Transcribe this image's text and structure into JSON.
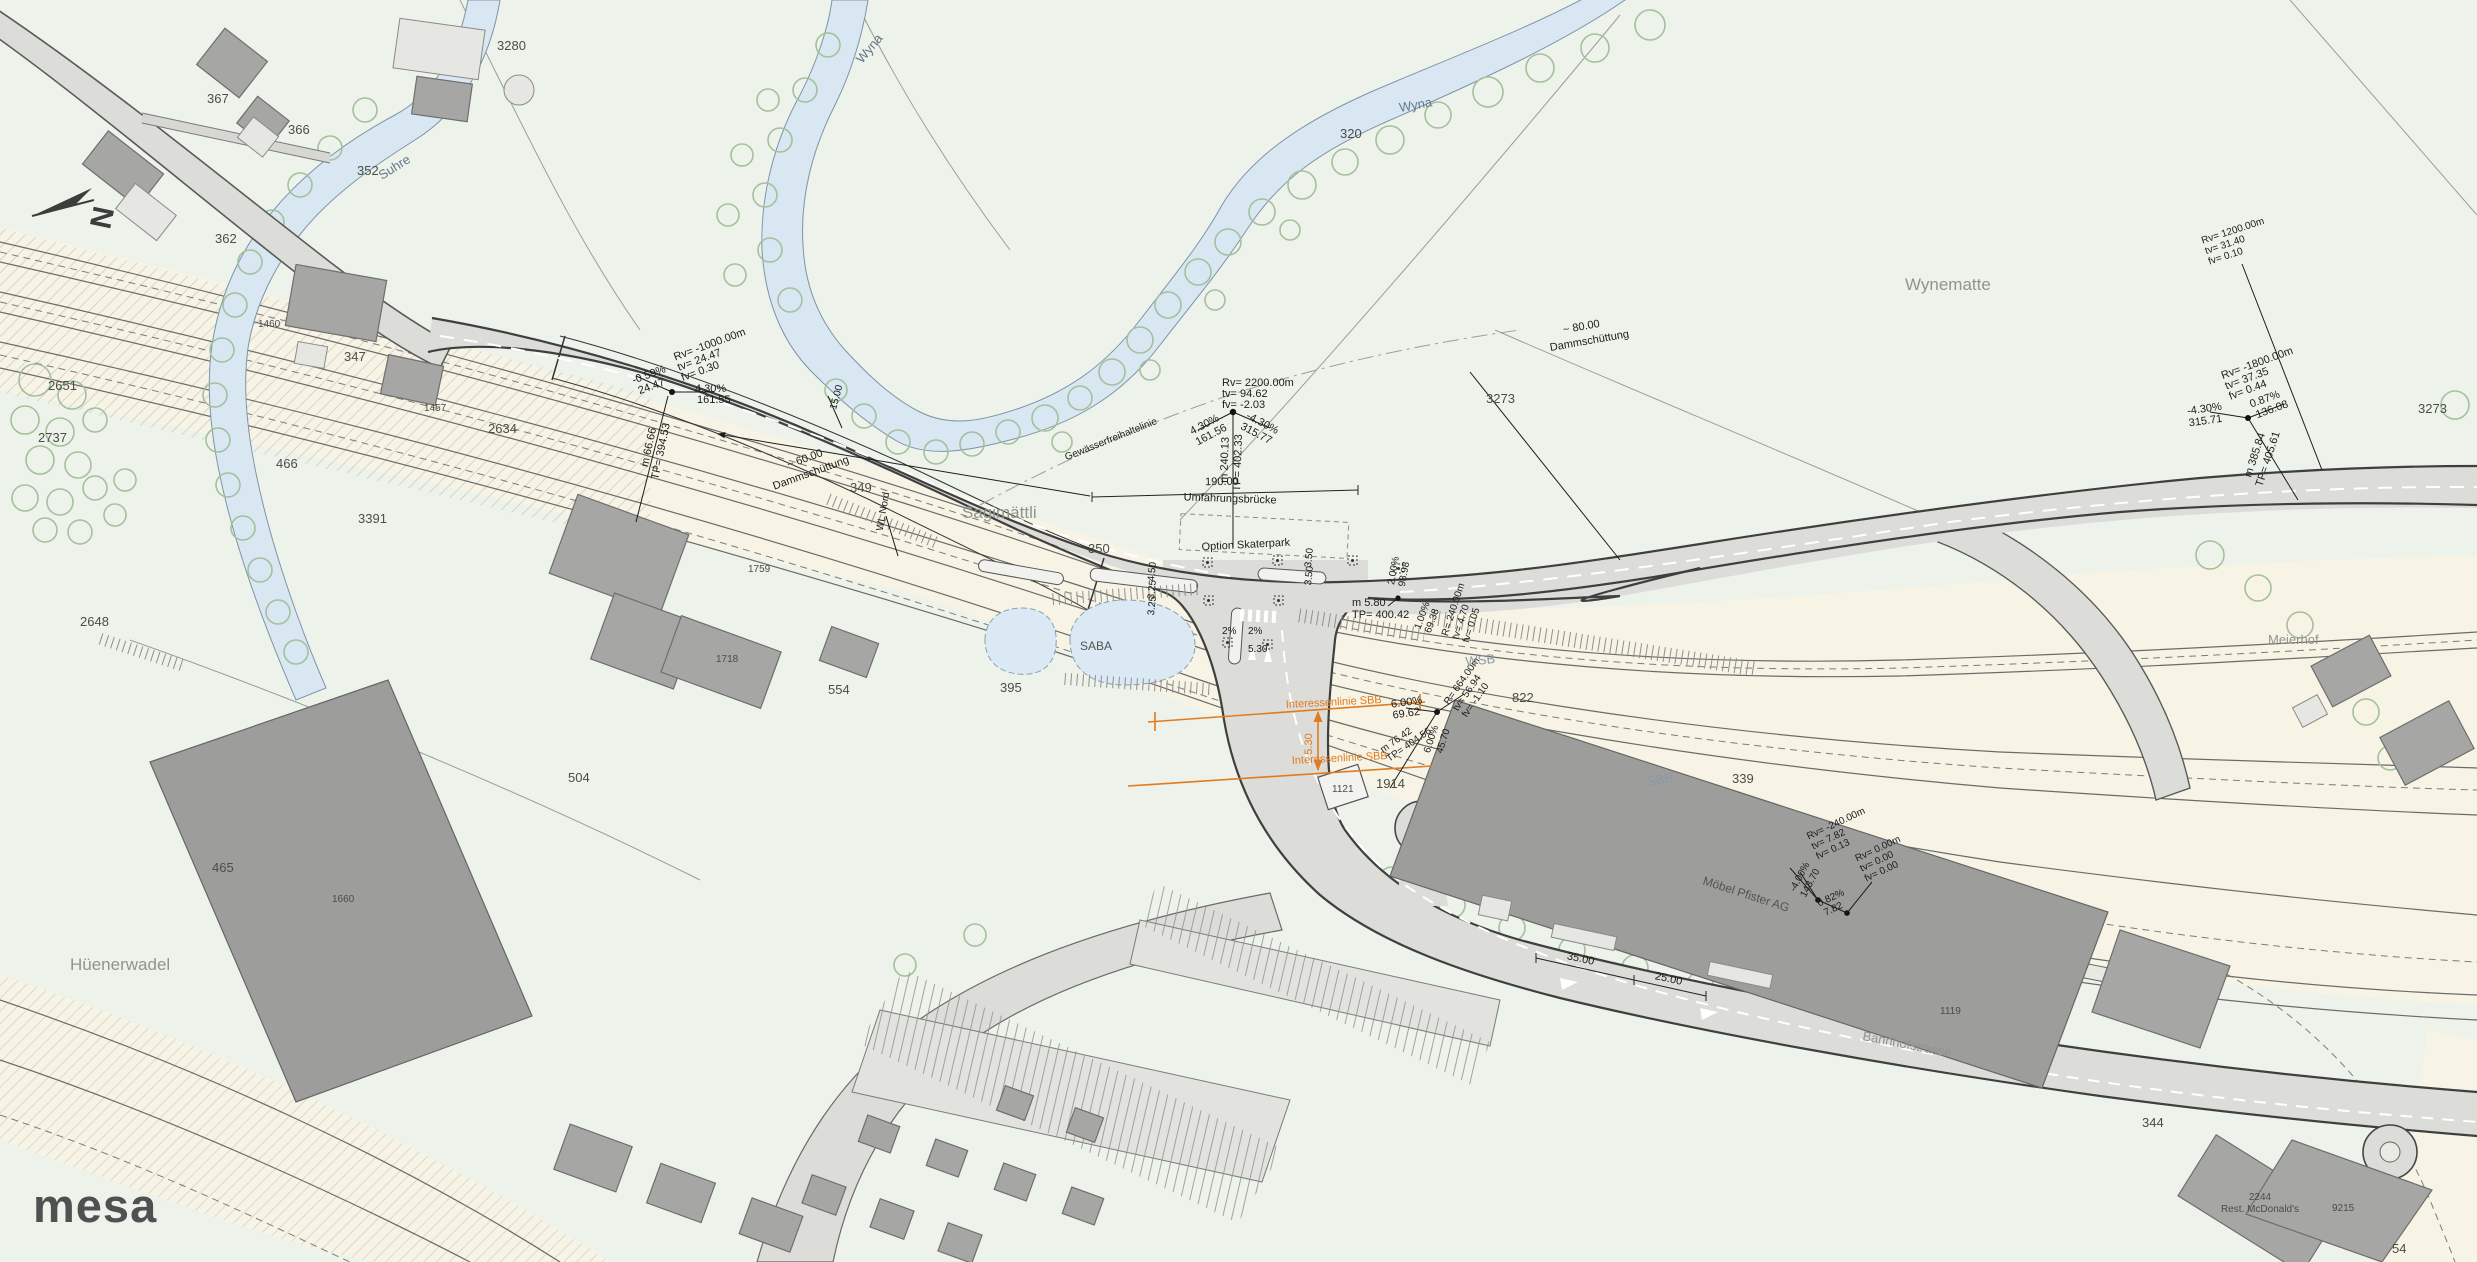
{
  "logo": {
    "text": "mesa"
  },
  "compass": {
    "letter": "N"
  },
  "labels": {
    "wyna1": "Wyna",
    "wyna2": "Wyna",
    "suhre": "Suhre",
    "wynematte": "Wynematte",
    "sagimaettli": "Sagimättli",
    "huenerwadel": "Hüenerwadel",
    "meierhof": "Meierhof",
    "saba": "SABA",
    "wsb": "WSB",
    "sbb": "SBB",
    "umfahrungsbruecke": "Umfahrungsbrücke",
    "bruecke_laenge": "190.00",
    "option_skaterpark": "Option Skaterpark",
    "interessenlinie1": "Interessenlinie SBB",
    "interessenlinie2": "Interessenlinie SBB",
    "wl_nord": "WL Nord",
    "gewaesserlinie": "Gewässerfreihaltelinie",
    "damm1_mass": "~ 60.00",
    "damm1": "Dammschüttung",
    "damm2_mass": "~ 80.00",
    "damm2": "Dammschüttung",
    "bahnhofstrasse": "Bahnhofstrasse",
    "moebel_pfister": "Möbel Pfister AG",
    "mcd_nr": "2244",
    "mcd": "Rest. McDonald's"
  },
  "parcels": {
    "p3280": "3280",
    "p367": "367",
    "p366": "366",
    "p352": "352",
    "p362": "362",
    "p320": "320",
    "p2648": "2648",
    "p2651": "2651",
    "p2737": "2737",
    "p466": "466",
    "p3391": "3391",
    "p347": "347",
    "p1460": "1460",
    "p1457": "1457",
    "p2634": "2634",
    "p349": "349",
    "p350": "350",
    "p3273a": "3273",
    "p3273b": "3273",
    "p465": "465",
    "p395": "395",
    "p1759": "1759",
    "p1660": "1660",
    "p1718": "1718",
    "p504": "504",
    "p554": "554",
    "p822": "822",
    "p339": "339",
    "p1914": "1914",
    "p1121": "1121",
    "p1119": "1119",
    "p344": "344",
    "p9215": "9215",
    "p54": "54"
  },
  "annotations": {
    "a": {
      "rv": "Rv= -1000.00m",
      "tv": "tv= 24.47",
      "fv": "fv= 0.30",
      "s1a": "-0.59%",
      "s1b": "24.47",
      "s2a": "4.30%",
      "s2b": "161.55",
      "v1": "m 66.66",
      "v2": "TP= 394.53",
      "dim": "15.00"
    },
    "b": {
      "rv": "Rv= 2200.00m",
      "tv": "tv= 94.62",
      "fv": "fv= -2.03",
      "s1a": "4.30%",
      "s1b": "161.56",
      "s2a": "-4.30%",
      "s2b": "315.77",
      "v1": "m 240.13",
      "v2": "TP= 402.33"
    },
    "c": {
      "rv": "Rv= -1800.00m",
      "tv": "tv= 37.35",
      "fv": "fv= 0.44",
      "s1a": "-4.30%",
      "s1b": "315.71",
      "s2a": "0.87%",
      "s2b": "136.08",
      "v1": "m 385.84",
      "v2": "TP= 405.61"
    },
    "d": {
      "rv": "Rv= 1200.00m",
      "tv": "tv= 31.40",
      "fv": "fv= 0.10"
    },
    "e": {
      "rv1": "Rv= -240.00m",
      "tv1": "tv= 7.82",
      "fv1": "fv= 0.13",
      "rv2": "Rv= 0.00m",
      "tv2": "tv= 0.00",
      "fv2": "fv= 0.00",
      "s1a": "-4.00%",
      "s1b": "143.70",
      "s2a": "0.82%",
      "s2b": "7.82"
    },
    "f": {
      "s1a": "6.00%",
      "s1b": "69.62",
      "r1": "R= 664.00m",
      "r2": "tv= 56.94",
      "r3": "fv= -1.10",
      "v1": "m 76.42",
      "v2": "TP= 404.56",
      "s2a": "6.00%",
      "s2b": "45.70"
    },
    "g": {
      "g1a": "2.00%",
      "g1b": "98.98",
      "g2a": "1.00%",
      "g2b": "69.38",
      "r1": "R= 240.00m",
      "r2": "tv= 4.70",
      "r3": "fv= 0.05"
    },
    "h": {
      "m": "m 5.80",
      "tp": "TP= 400.42"
    },
    "lanes": {
      "w1": "4.50",
      "w2": "3.25",
      "w3": "3.25",
      "w4": "3.50",
      "w5": "3.50",
      "q1": "2%",
      "q2": "2%",
      "q3": "5.30"
    },
    "dims": {
      "d35": "35.00",
      "d25": "25.00",
      "o530": "5.30"
    }
  }
}
